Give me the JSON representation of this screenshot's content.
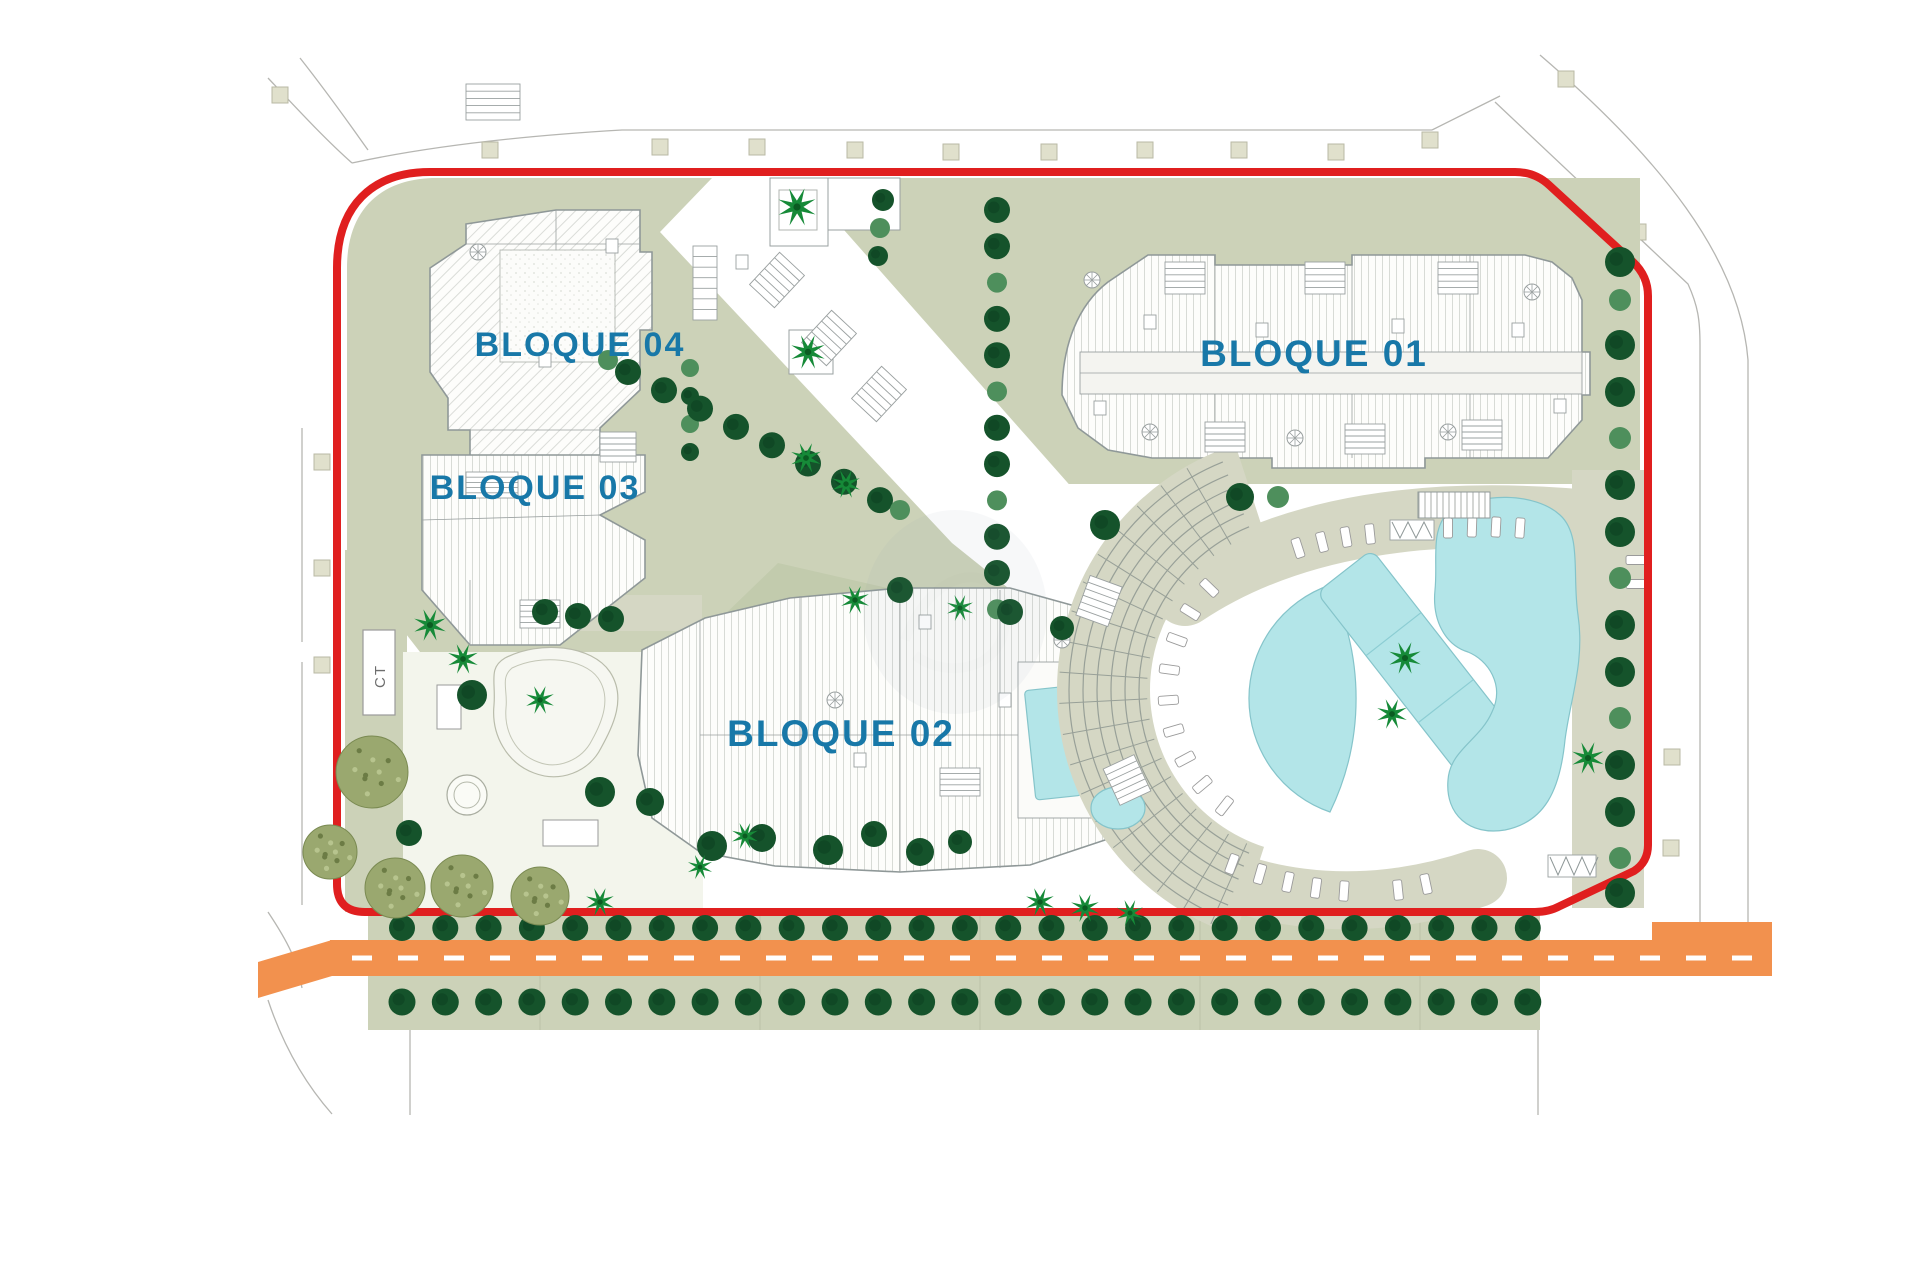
{
  "plan": {
    "type": "residential site plan",
    "labels": {
      "block01": "BLOQUE 01",
      "block02": "BLOQUE 02",
      "block03": "BLOQUE 03",
      "block04": "BLOQUE 04",
      "utility": "CT"
    },
    "features": {
      "boundary": "red plot boundary",
      "road": "orange street with dashed centerline",
      "pools": "communal lagoon, lap pool, crescent pool, spa, rooftop pool",
      "amphitheatre": "curved terraced deck with sun loungers",
      "trees": "street tree rows, garden trees, palms, olive trees"
    },
    "colors": {
      "boundary": "#e01f1f",
      "label_text": "#1878a8",
      "lawn": "#ccd2b8",
      "lawn_dark": "#c2cbad",
      "deck": "#d5d7c4",
      "pool": "#b3e5e8",
      "road": "#f2914e",
      "tree_dark": "#15532b",
      "tree_medium": "#4e8f5c",
      "palm": "#168a38",
      "olive": "#9aa86f"
    }
  }
}
